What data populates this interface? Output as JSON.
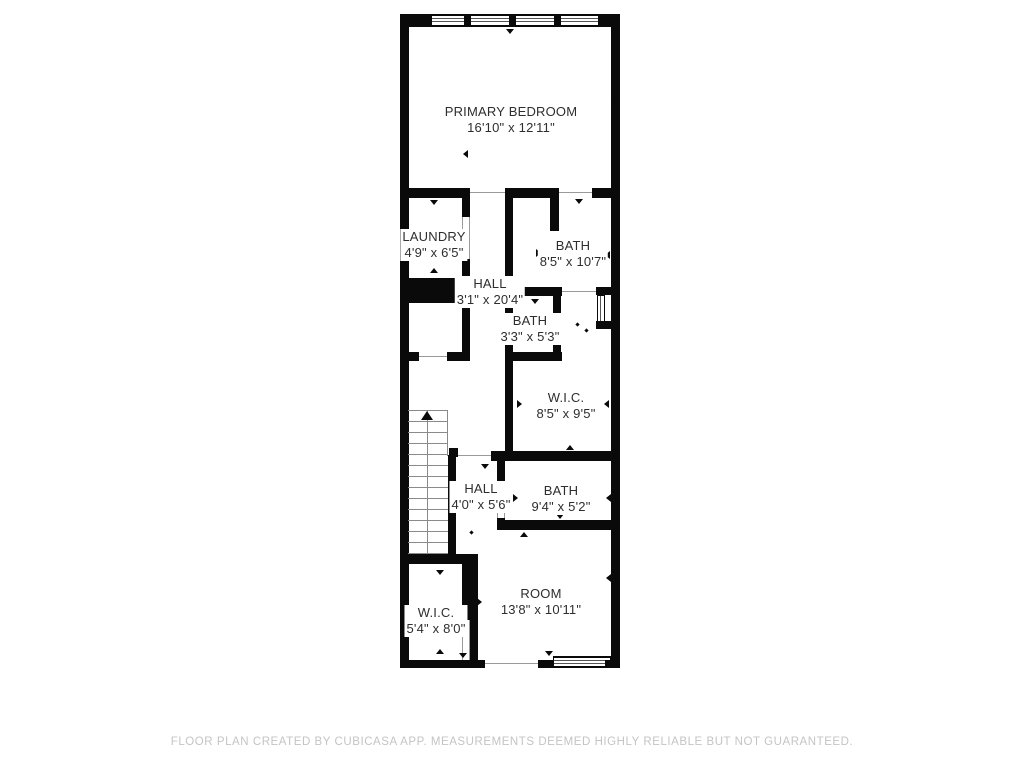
{
  "plan": {
    "title_footer": "FLOOR PLAN CREATED BY CUBICASA APP. MEASUREMENTS DEEMED HIGHLY RELIABLE BUT NOT GUARANTEED.",
    "colors": {
      "wall": "#0a0a0a",
      "label": "#2e2e2e",
      "footer": "#c4c4c4",
      "opening_line": "#9a9a9a",
      "stair_line": "#8a8a8a"
    },
    "rooms": [
      {
        "id": "primary-bedroom",
        "name": "PRIMARY BEDROOM",
        "dims": "16'10\" x 12'11\""
      },
      {
        "id": "laundry",
        "name": "LAUNDRY",
        "dims": "4'9\" x 6'5\""
      },
      {
        "id": "hall-upper",
        "name": "HALL",
        "dims": "3'1\" x 20'4\""
      },
      {
        "id": "bath-primary",
        "name": "BATH",
        "dims": "8'5\" x 10'7\""
      },
      {
        "id": "bath-small",
        "name": "BATH",
        "dims": "3'3\" x 5'3\""
      },
      {
        "id": "wic-upper",
        "name": "W.I.C.",
        "dims": "8'5\" x 9'5\""
      },
      {
        "id": "hall-lower",
        "name": "HALL",
        "dims": "4'0\" x 5'6\""
      },
      {
        "id": "bath-lower",
        "name": "BATH",
        "dims": "9'4\" x 5'2\""
      },
      {
        "id": "wic-lower",
        "name": "W.I.C.",
        "dims": "5'4\" x 8'0\""
      },
      {
        "id": "room",
        "name": "ROOM",
        "dims": "13'8\" x 10'11\""
      }
    ],
    "stairs": {
      "direction": "up",
      "treads": 13
    },
    "markers": [
      {
        "x": 506,
        "y": 29,
        "d": "down"
      },
      {
        "x": 403,
        "y": 95,
        "d": "right"
      },
      {
        "x": 612,
        "y": 95,
        "d": "left"
      },
      {
        "x": 430,
        "y": 200,
        "d": "down"
      },
      {
        "x": 403,
        "y": 150,
        "d": "right"
      },
      {
        "x": 463,
        "y": 150,
        "d": "left"
      },
      {
        "x": 430,
        "y": 268,
        "d": "up"
      },
      {
        "x": 575,
        "y": 199,
        "d": "down"
      },
      {
        "x": 536,
        "y": 249,
        "d": "right"
      },
      {
        "x": 605,
        "y": 251,
        "d": "left"
      },
      {
        "x": 531,
        "y": 299,
        "d": "down"
      },
      {
        "x": 509,
        "y": 321,
        "d": "right"
      },
      {
        "x": 548,
        "y": 321,
        "d": "left"
      },
      {
        "x": 576,
        "y": 323,
        "d": "dot"
      },
      {
        "x": 585,
        "y": 329,
        "d": "dot"
      },
      {
        "x": 517,
        "y": 400,
        "d": "right"
      },
      {
        "x": 604,
        "y": 400,
        "d": "left"
      },
      {
        "x": 566,
        "y": 445,
        "d": "up"
      },
      {
        "x": 481,
        "y": 464,
        "d": "down"
      },
      {
        "x": 470,
        "y": 531,
        "d": "dot"
      },
      {
        "x": 513,
        "y": 494,
        "d": "right"
      },
      {
        "x": 606,
        "y": 494,
        "d": "left"
      },
      {
        "x": 520,
        "y": 532,
        "d": "up"
      },
      {
        "x": 556,
        "y": 514,
        "d": "down"
      },
      {
        "x": 404,
        "y": 608,
        "d": "right"
      },
      {
        "x": 463,
        "y": 608,
        "d": "left"
      },
      {
        "x": 436,
        "y": 570,
        "d": "down"
      },
      {
        "x": 436,
        "y": 649,
        "d": "up"
      },
      {
        "x": 477,
        "y": 598,
        "d": "right"
      },
      {
        "x": 606,
        "y": 574,
        "d": "left"
      },
      {
        "x": 459,
        "y": 653,
        "d": "down"
      },
      {
        "x": 545,
        "y": 651,
        "d": "down"
      }
    ]
  }
}
